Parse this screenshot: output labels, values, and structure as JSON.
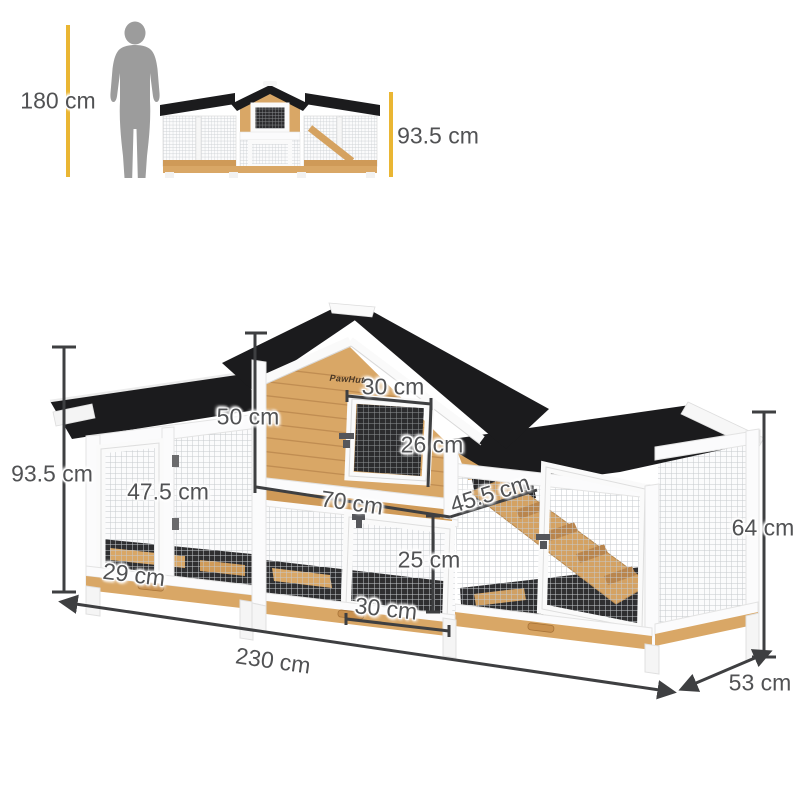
{
  "scale_reference": {
    "person_height": "180 cm",
    "front_height": "93.5 cm"
  },
  "brand_logo": "PawHut",
  "dimensions": {
    "house_front_height": "50 cm",
    "window_width": "30 cm",
    "window_height": "26 cm",
    "upper_hutch_width": "70 cm",
    "ramp_length": "45.5 cm",
    "left_door_height": "47.5 cm",
    "ground_clearance": "29 cm",
    "lower_door_height": "25 cm",
    "lower_door_width": "30 cm",
    "overall_height": "93.5 cm",
    "run_side_height": "64 cm",
    "overall_width": "230 cm",
    "overall_depth": "53 cm"
  },
  "colors": {
    "accent_yellow": "#eab633",
    "dimension_line": "#3e3f41",
    "label_text": "#515254",
    "roof_black": "#1b1b1d",
    "wood_light": "#d9a766",
    "wood_dark": "#bf8b51",
    "frame_white": "#fbfbfc",
    "silhouette_gray": "#9c9c9c"
  }
}
